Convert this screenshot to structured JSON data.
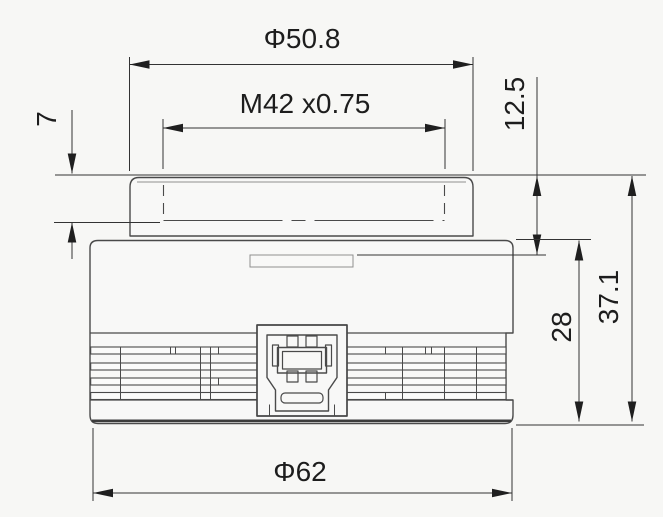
{
  "drawing": {
    "title": "camera-body-dimension-drawing",
    "view": "front view with M42 lens mount, heatsink grooves and I/O connector",
    "background_color": "#f7f7f5",
    "outline_color": "#4a4a4a",
    "dimension_color": "#1d1d1d"
  },
  "dimensions": {
    "top_diameter": {
      "label": "Φ50.8",
      "orientation": "horizontal"
    },
    "thread": {
      "label": "M42 x0.75",
      "orientation": "horizontal"
    },
    "thread_depth": {
      "label": "7",
      "orientation": "vertical"
    },
    "mount_height": {
      "label": "12.5",
      "orientation": "vertical"
    },
    "body_height": {
      "label": "28",
      "orientation": "vertical"
    },
    "overall_height": {
      "label": "37.1",
      "orientation": "vertical"
    },
    "body_diameter": {
      "label": "Φ62",
      "orientation": "horizontal"
    }
  }
}
